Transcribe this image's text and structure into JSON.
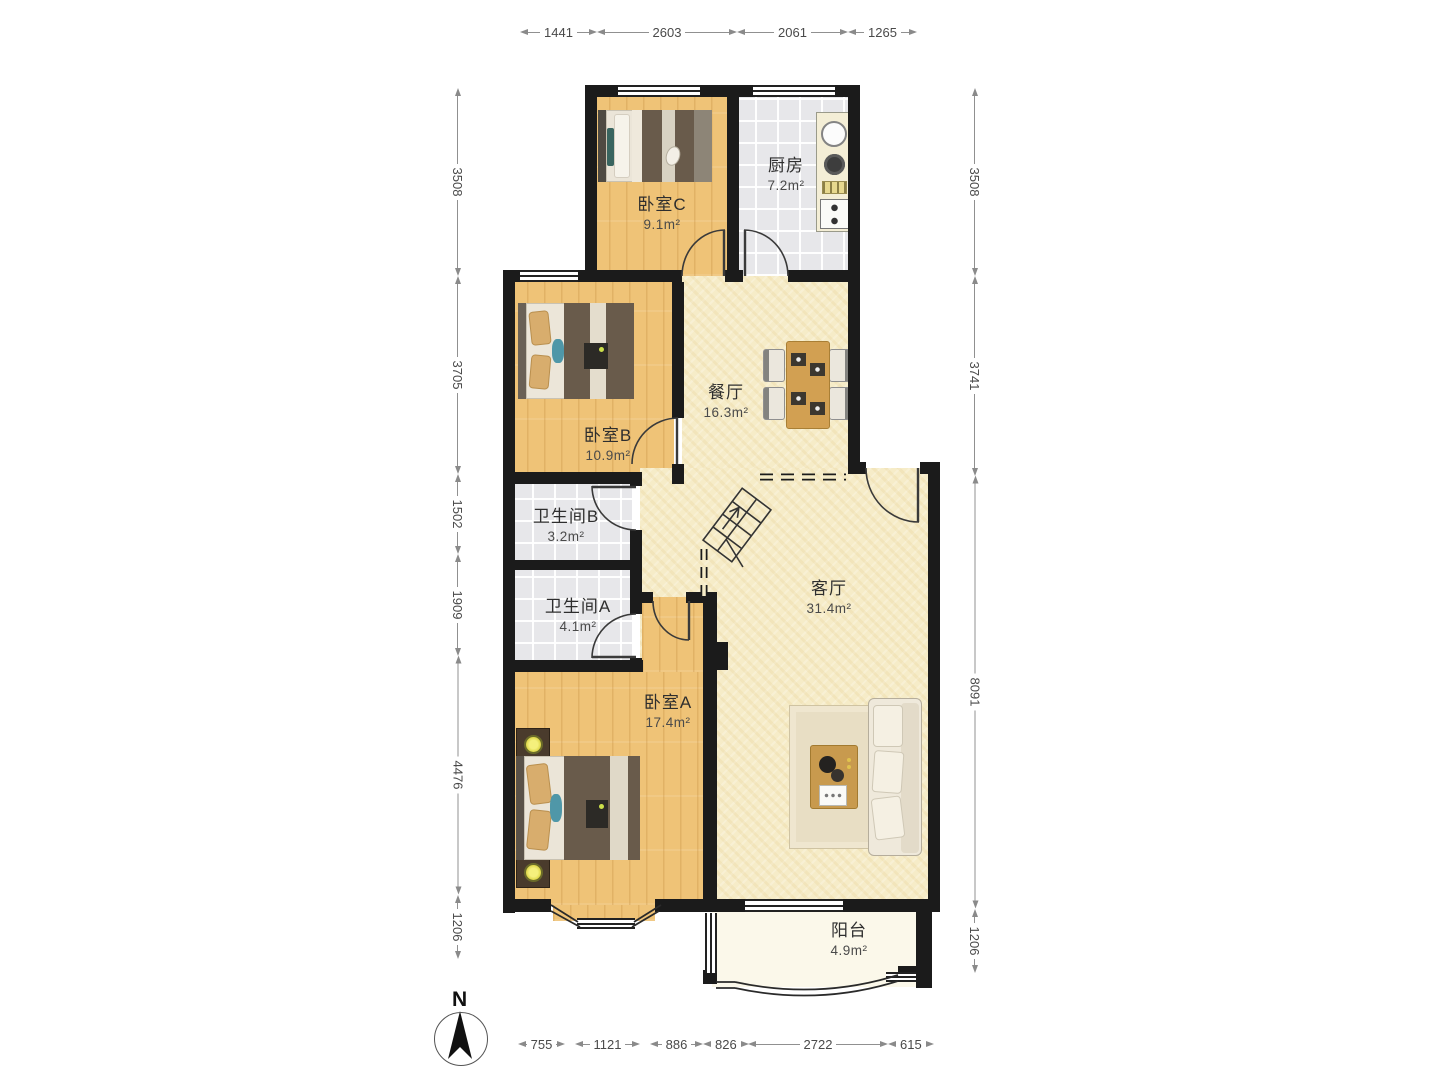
{
  "floor_plan": {
    "unit": "m²",
    "rooms": [
      {
        "name": "卧室C",
        "area": "9.1"
      },
      {
        "name": "厨房",
        "area": "7.2"
      },
      {
        "name": "卧室B",
        "area": "10.9"
      },
      {
        "name": "餐厅",
        "area": "16.3"
      },
      {
        "name": "卫生间B",
        "area": "3.2"
      },
      {
        "name": "卫生间A",
        "area": "4.1"
      },
      {
        "name": "卧室A",
        "area": "17.4"
      },
      {
        "name": "客厅",
        "area": "31.4"
      },
      {
        "name": "阳台",
        "area": "4.9"
      }
    ],
    "dimensions_mm": {
      "top": [
        "1441",
        "2603",
        "2061",
        "1265"
      ],
      "bottom": [
        "755",
        "1121",
        "886",
        "826",
        "2722",
        "615"
      ],
      "left": [
        "3508",
        "3705",
        "1502",
        "1909",
        "4476",
        "1206"
      ],
      "right": [
        "3508",
        "3741",
        "8091",
        "1206"
      ]
    },
    "compass": {
      "label": "N"
    },
    "colors": {
      "wall": "#1b1b1b",
      "wood_floor": "#efc377",
      "tile_floor": "#e7e7ea",
      "open_floor": "#f6ecc8",
      "balcony_floor": "#fbf8ea",
      "furniture_wood": "#d2a052",
      "dim_text": "#4a4a4a"
    }
  }
}
